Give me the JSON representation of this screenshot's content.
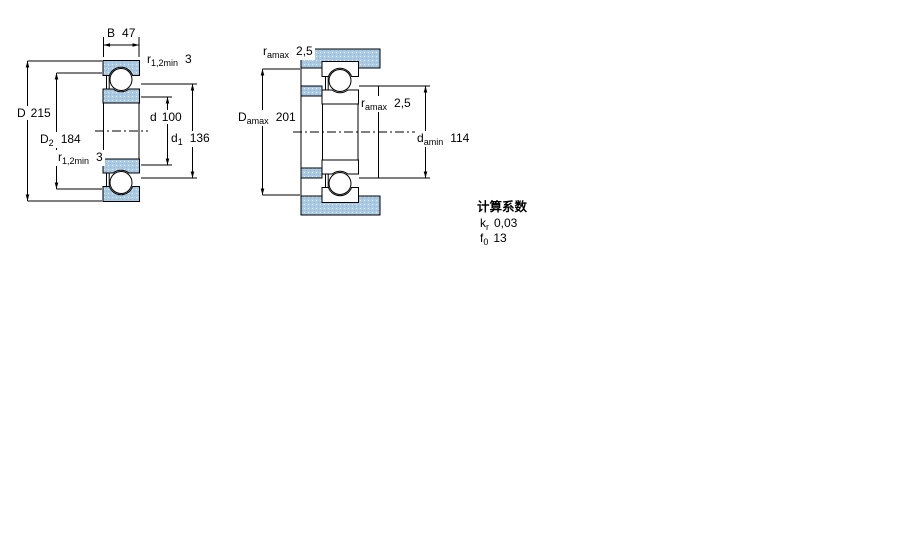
{
  "drawing_title": "bearing-dimension-drawing",
  "colors": {
    "section_fill": "#aac9e2",
    "line_color": "#000000",
    "background": "#ffffff"
  },
  "diagram_left": {
    "name": "bearing cross-section with boundary dimensions",
    "dims": {
      "B": {
        "symbol": "B",
        "sub": "",
        "value": "47"
      },
      "r12_top": {
        "symbol": "r",
        "sub": "1,2min",
        "value": "3"
      },
      "D": {
        "symbol": "D",
        "sub": "",
        "value": "215"
      },
      "D2": {
        "symbol": "D",
        "sub": "2",
        "value": "184"
      },
      "r12_bot": {
        "symbol": "r",
        "sub": "1,2min",
        "value": "3"
      },
      "d": {
        "symbol": "d",
        "sub": "",
        "value": "100"
      },
      "d1": {
        "symbol": "d",
        "sub": "1",
        "value": "136"
      }
    }
  },
  "diagram_right": {
    "name": "bearing mounting / abutment dimensions",
    "dims": {
      "ra_top": {
        "symbol": "r",
        "sub": "amax",
        "value": "2,5"
      },
      "Damax": {
        "symbol": "D",
        "sub": "amax",
        "value": "201"
      },
      "ra_mid": {
        "symbol": "r",
        "sub": "amax",
        "value": "2,5"
      },
      "damin": {
        "symbol": "d",
        "sub": "amin",
        "value": "114"
      }
    }
  },
  "calculation_factors": {
    "title": "计算系数",
    "rows": [
      {
        "symbol": "k",
        "sub": "r",
        "value": "0,03"
      },
      {
        "symbol": "f",
        "sub": "0",
        "value": "13"
      }
    ]
  }
}
